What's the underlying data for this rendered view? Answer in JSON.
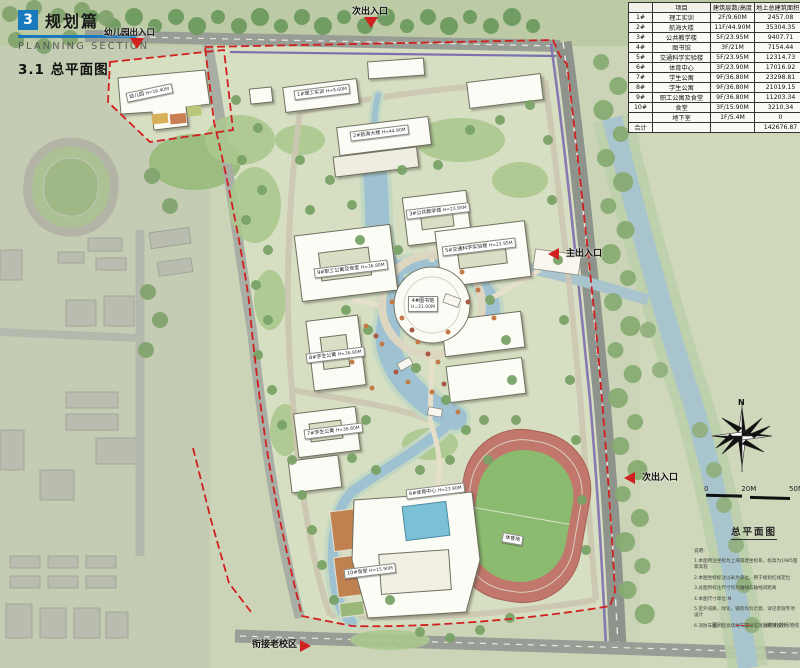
{
  "header": {
    "section_number": "3",
    "section_title": "规划篇",
    "section_subtitle": "PLANNING SECTION",
    "page_title": "3.1 总平面图"
  },
  "table": {
    "headers": [
      "",
      "项目",
      "建筑层数/高度",
      "地上总建筑面积（㎡）"
    ],
    "rows": [
      [
        "1#",
        "理工实训",
        "2F/9.60M",
        "2457.08"
      ],
      [
        "2#",
        "航海大楼",
        "11F/44.90M",
        "35304.35"
      ],
      [
        "3#",
        "公共教学楼",
        "5F/23.95M",
        "9407.71"
      ],
      [
        "4#",
        "图书馆",
        "3F/21M",
        "7154.44"
      ],
      [
        "5#",
        "交通科学实验楼",
        "5F/23.95M",
        "12314.73"
      ],
      [
        "6#",
        "体育中心",
        "3F/23.90M",
        "17016.92"
      ],
      [
        "7#",
        "学生公寓",
        "9F/36.80M",
        "23298.81"
      ],
      [
        "8#",
        "学生公寓",
        "9F/36.80M",
        "21019.15"
      ],
      [
        "9#",
        "职工公寓及食堂",
        "9F/36.80M",
        "11203.34"
      ],
      [
        "10#",
        "食堂",
        "3F/15.90M",
        "3210.34"
      ],
      [
        "",
        "地下室",
        "1F/5.4M",
        "0"
      ],
      [
        "合计",
        "",
        "",
        "142676.87"
      ]
    ]
  },
  "entrances": {
    "north_secondary": "次出入口",
    "kindergarten": "幼儿园出入口",
    "main": "主出入口",
    "east_secondary": "次出入口",
    "old_campus": "衔接老校区"
  },
  "map_labels": [
    {
      "line1": "幼儿园",
      "line2": "H=16.40M"
    },
    {
      "line1": "1#理工实训",
      "line2": "H=9.60M"
    },
    {
      "line1": "2#航海大楼",
      "line2": "H=44.90M"
    },
    {
      "line1": "3#公共教学楼",
      "line2": "H=23.95M"
    },
    {
      "line1": "5#交通科学实验楼",
      "line2": "H=23.95M"
    },
    {
      "line1": "9#职工公寓及食堂",
      "line2": "H=36.80M"
    },
    {
      "line1": "4#图书馆",
      "line2": "H=21.00M"
    },
    {
      "line1": "8#学生公寓",
      "line2": "H=36.80M"
    },
    {
      "line1": "7#学生公寓",
      "line2": "H=36.80M"
    },
    {
      "line1": "10#食堂",
      "line2": "H=15.90M"
    },
    {
      "line1": "6#体育中心",
      "line2": "H=23.90M"
    },
    {
      "line1": "体育场",
      "line2": ""
    }
  ],
  "compass": {
    "north_label": "N"
  },
  "scale_bar": {
    "ticks": [
      "0",
      "20M",
      "50M"
    ]
  },
  "plan_name": "总平面图",
  "notes": {
    "intro": "说明:",
    "items": [
      "1.本图所注坐标为上海城建坐标系，标高为1985国家高程",
      "2.本图坐标标注以米为单位，用于规划红线定位",
      "3.总图所标注尺寸均为轴线与轴线间距离",
      "4.本图尺寸单位:M",
      "5.室外道路、绿化、铺装均为示意，详见景观专项设计",
      "6.消防车道、登高场地布置详见消防专项设计"
    ]
  },
  "legend": {
    "title": "图例",
    "item": "消防扑救场地线"
  },
  "colors": {
    "accent_blue": "#1879bd",
    "boundary_red": "#d02020",
    "planning_purple": "#7e6fae",
    "water": "#9fc2d2"
  }
}
